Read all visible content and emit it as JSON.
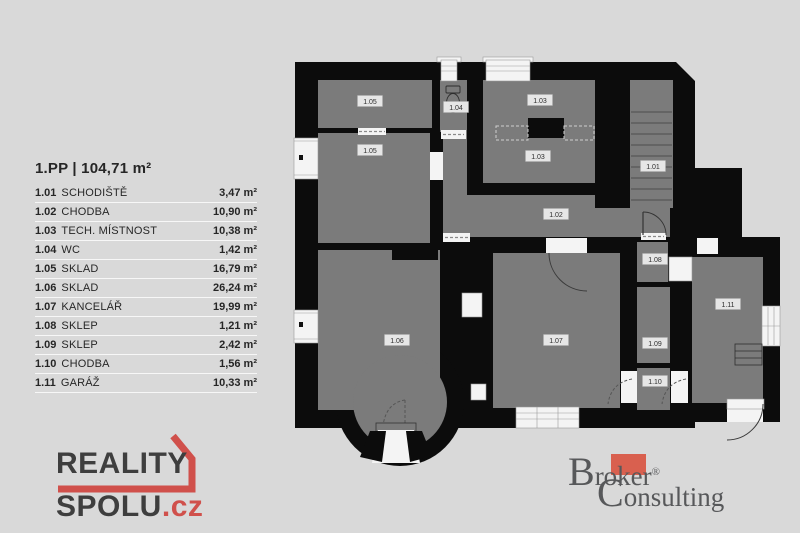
{
  "legend": {
    "title": "1.PP | 104,71 m²",
    "rows": [
      {
        "code": "1.01",
        "name": "SCHODIŠTĚ",
        "area": "3,47 m²"
      },
      {
        "code": "1.02",
        "name": "CHODBA",
        "area": "10,90 m²"
      },
      {
        "code": "1.03",
        "name": "TECH. MÍSTNOST",
        "area": "10,38 m²"
      },
      {
        "code": "1.04",
        "name": "WC",
        "area": "1,42 m²"
      },
      {
        "code": "1.05",
        "name": "SKLAD",
        "area": "16,79 m²"
      },
      {
        "code": "1.06",
        "name": "SKLAD",
        "area": "26,24 m²"
      },
      {
        "code": "1.07",
        "name": "KANCELÁŘ",
        "area": "19,99 m²"
      },
      {
        "code": "1.08",
        "name": "SKLEP",
        "area": "1,21 m²"
      },
      {
        "code": "1.09",
        "name": "SKLEP",
        "area": "2,42 m²"
      },
      {
        "code": "1.10",
        "name": "CHODBA",
        "area": "1,56 m²"
      },
      {
        "code": "1.11",
        "name": "GARÁŽ",
        "area": "10,33 m²"
      }
    ]
  },
  "plan": {
    "labels": [
      "1.05",
      "1.05",
      "1.04",
      "1.03",
      "1.03",
      "1.01",
      "1.02",
      "1.08",
      "1.06",
      "1.07",
      "1.09",
      "1.10",
      "1.11"
    ]
  },
  "logos": {
    "reality": {
      "line1": "REALITY",
      "line2": "SPOLU",
      "tld": ".cz"
    },
    "broker": {
      "word1_cap": "B",
      "word1_rest": "roker",
      "reg": "®",
      "word2_cap": "C",
      "word2_rest": "onsulting"
    }
  },
  "colors": {
    "background": "#d9d9d9",
    "wall_black": "#0c0c0c",
    "room_gray": "#7b7b7b",
    "opening_white": "#f4f4f4",
    "reality_red": "#d0504b",
    "broker_red": "#d9604f",
    "text_dark": "#262626"
  }
}
